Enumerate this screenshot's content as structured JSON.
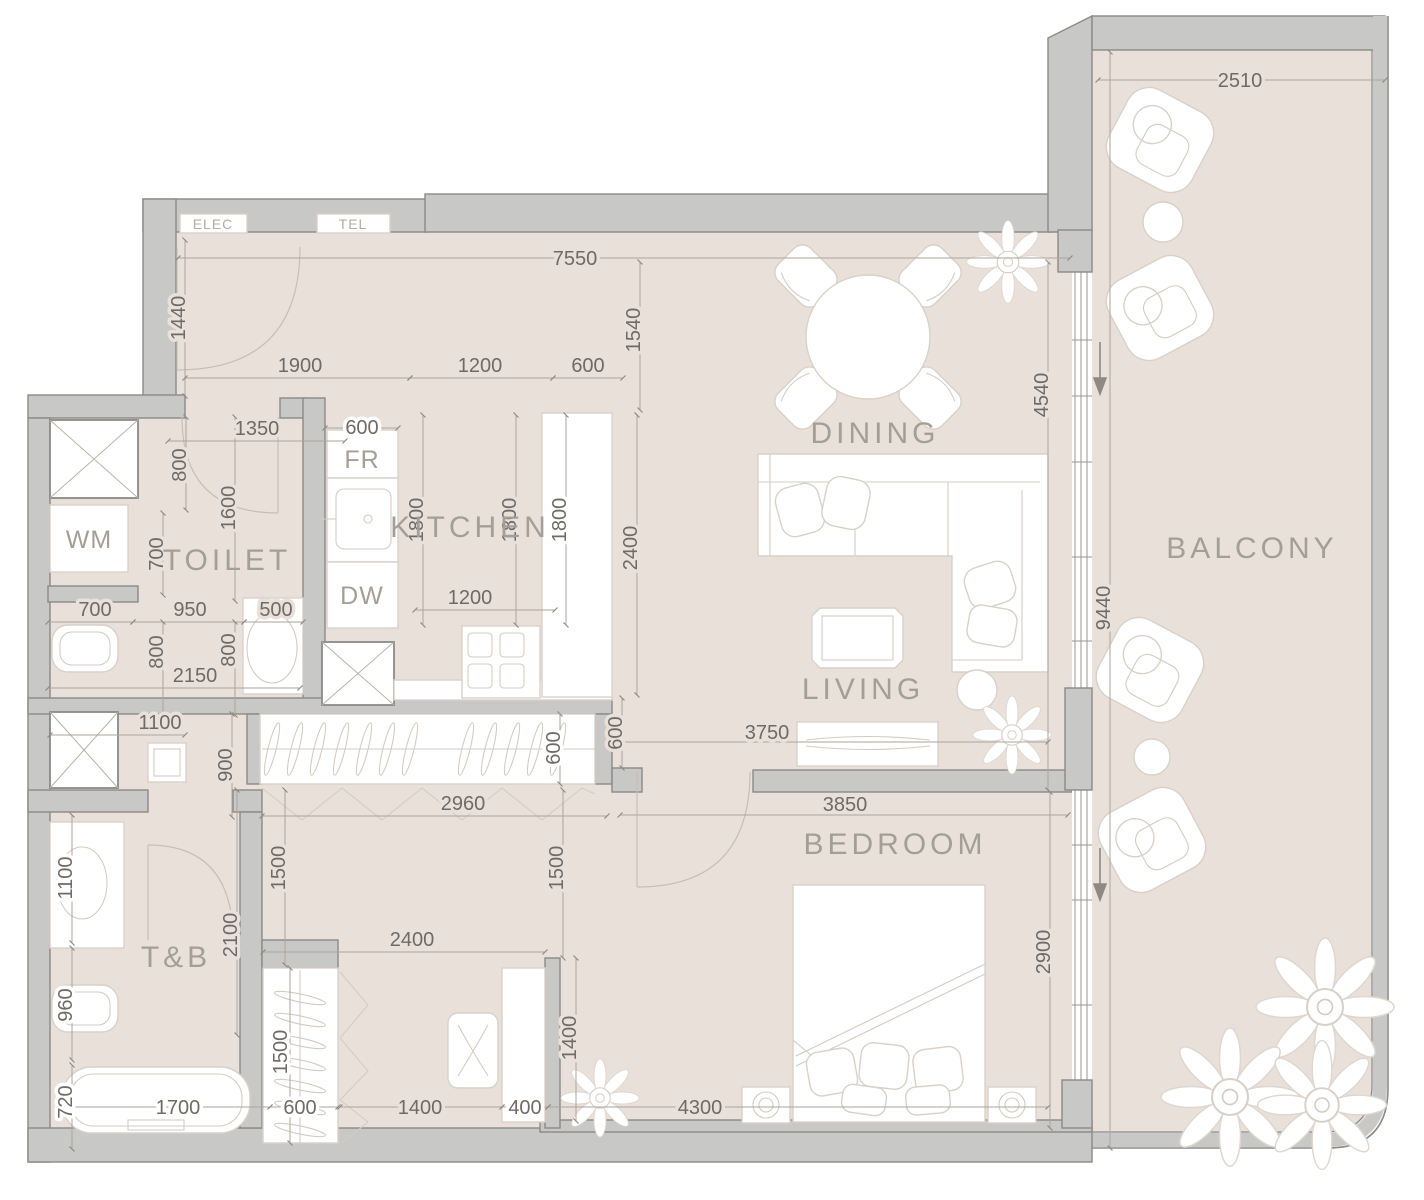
{
  "rooms": {
    "dining": "DINING",
    "kitchen": "KITCHEN",
    "toilet": "TOILET",
    "living": "LIVING",
    "balcony": "BALCONY",
    "bedroom": "BEDROOM",
    "tb": "T&B"
  },
  "fixtures": {
    "wm": "WM",
    "fr": "FR",
    "dw": "DW",
    "elec": "ELEC",
    "tel": "TEL"
  },
  "dims": {
    "d2510": "2510",
    "d7550": "7550",
    "d1440": "1440",
    "d1540": "1540",
    "d1900": "1900",
    "d1200a": "1200",
    "d600a": "600",
    "d1350": "1350",
    "d600b": "600",
    "d800a": "800",
    "d1600": "1600",
    "d700a": "700",
    "d1800a": "1800",
    "d1800b": "1800",
    "d1800c": "1800",
    "d2400a": "2400",
    "d1200b": "1200",
    "d700b": "700",
    "d950": "950",
    "d500": "500",
    "d800b": "800",
    "d800c": "800",
    "d2150": "2150",
    "d4540": "4540",
    "d1100a": "1100",
    "d900": "900",
    "d2960": "2960",
    "d600d": "600",
    "d600e": "600",
    "d1500a": "1500",
    "d1500b": "1500",
    "d3750": "3750",
    "d3850": "3850",
    "d2100": "2100",
    "d1100b": "1100",
    "d960": "960",
    "d720": "720",
    "d1700": "1700",
    "d600f": "600",
    "d1400a": "1400",
    "d400": "400",
    "d4300": "4300",
    "d1500c": "1500",
    "d1400b": "1400",
    "d2900": "2900",
    "d9440": "9440",
    "d2400b": "2400"
  },
  "colors": {
    "wall": "#c8c8c6",
    "wallEdge": "#8b8a88",
    "floor": "#e9e0d9",
    "dimText": "#6f6a66",
    "labelText": "#a59e97"
  }
}
